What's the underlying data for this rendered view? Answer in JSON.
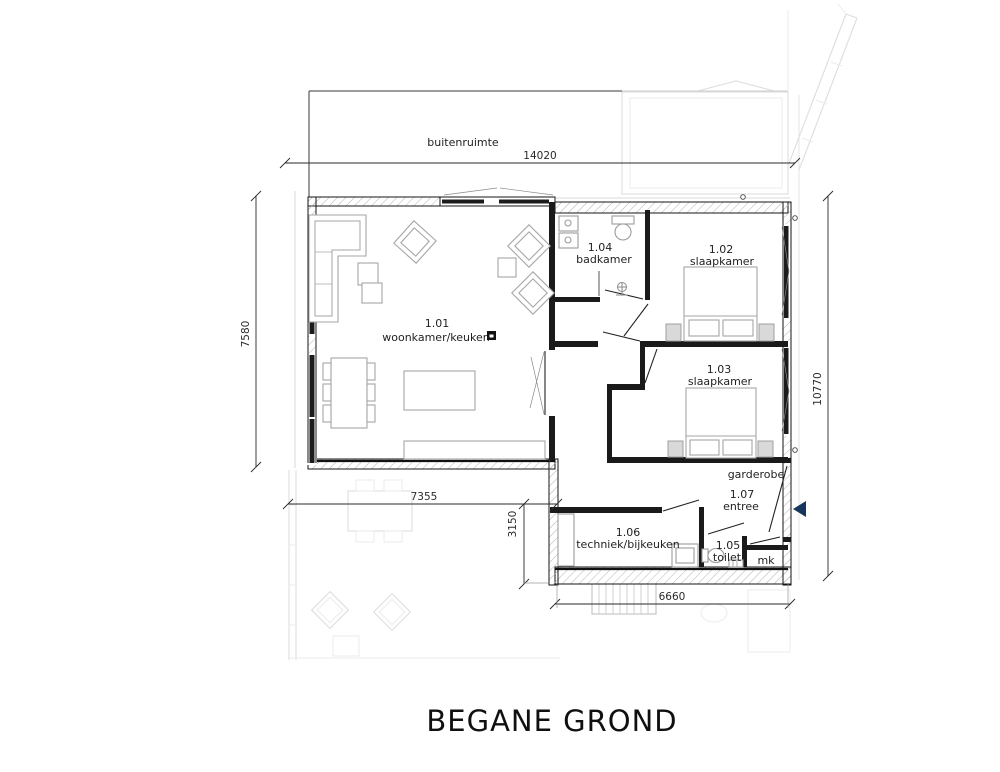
{
  "title": "BEGANE GROND",
  "plan": {
    "outdoor_label": "buitenruimte",
    "rooms": [
      {
        "id": "1.01",
        "name": "woonkamer/keuken"
      },
      {
        "id": "1.02",
        "name": "slaapkamer"
      },
      {
        "id": "1.03",
        "name": "slaapkamer"
      },
      {
        "id": "1.04",
        "name": "badkamer"
      },
      {
        "id": "1.05",
        "name": "toilet"
      },
      {
        "id": "1.06",
        "name": "techniek/bijkeuken"
      },
      {
        "id": "1.07",
        "name": "entree"
      }
    ],
    "labels": {
      "garderobe": "garderobe",
      "meterkast": "mk"
    },
    "dimensions": {
      "top": "14020",
      "left": "7580",
      "right": "10770",
      "bottom_left": "7355",
      "middle": "3150",
      "bottom_right": "6660"
    },
    "colors": {
      "wall": "#1a1a1a",
      "furniture": "#a6a6a6",
      "ghost": "#dedede",
      "entrance_arrow": "#17365d"
    }
  }
}
